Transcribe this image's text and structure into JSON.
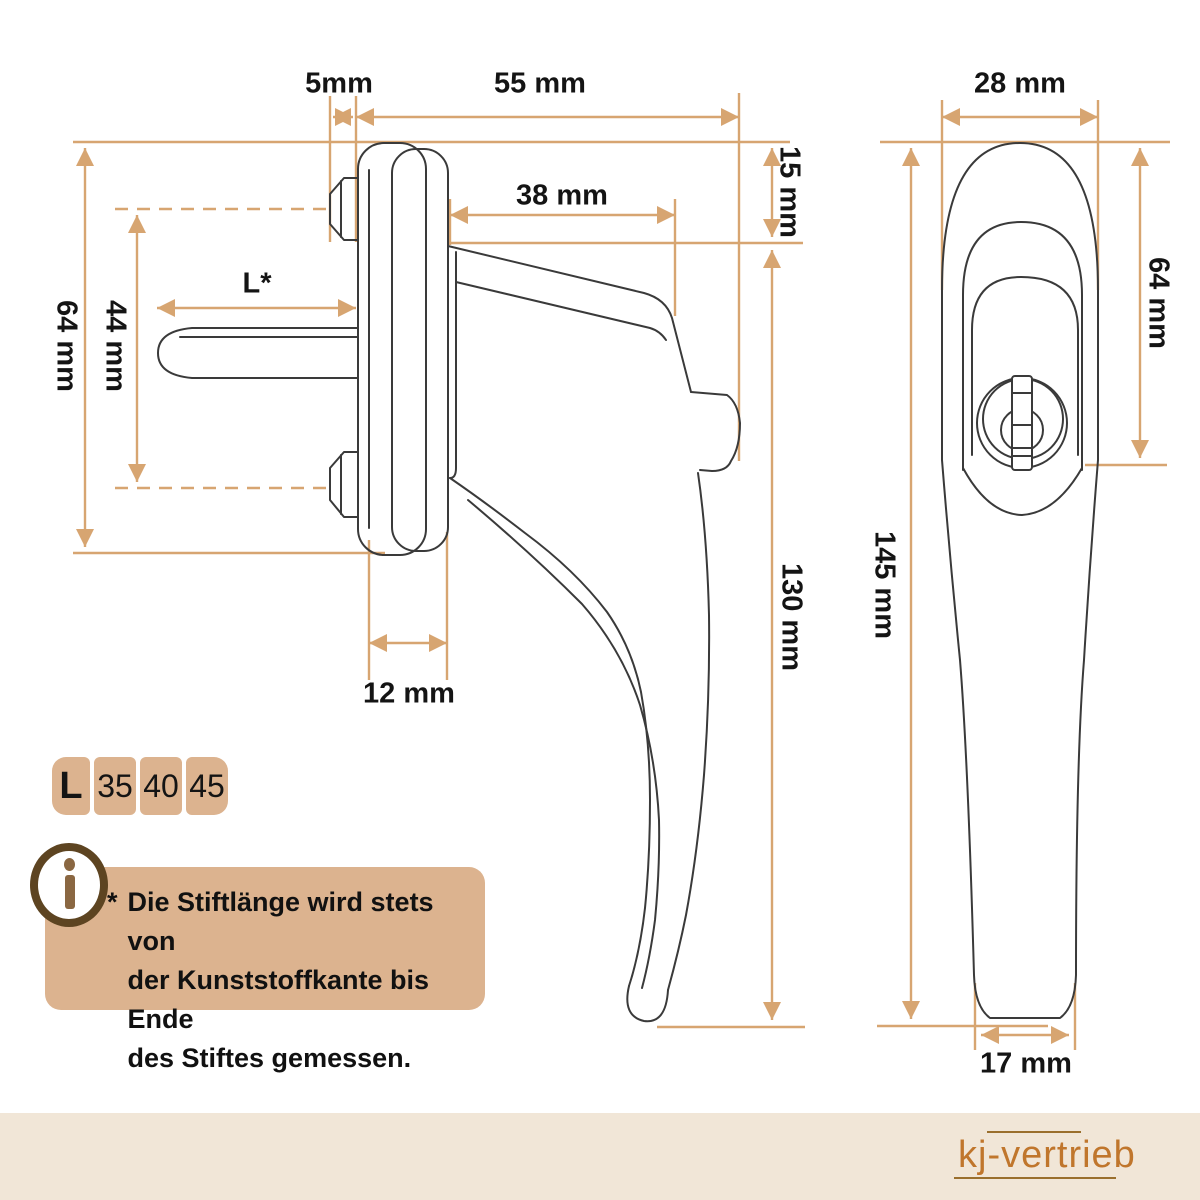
{
  "title": "Fenstergriff Masszeichnung",
  "colors": {
    "dimension_accent": "#d7a571",
    "drawing_line": "#3a3a3a",
    "panel_tan": "#dcb38f",
    "footer_beige": "#f1e6d7",
    "brand_orange": "#c0762c",
    "icon_ring_brown": "#5d4421",
    "icon_glyph_brown": "#8a6742"
  },
  "side_view": {
    "pin_offset": "5mm",
    "handle_depth": "55 mm",
    "neck_length": "38 mm",
    "cover_height": "15 mm",
    "handle_height": "130 mm",
    "rosette_height": "64 mm",
    "screw_spacing": "44 mm",
    "spindle_length": "L*",
    "rosette_depth": "12 mm"
  },
  "front_view": {
    "handle_width": "28 mm",
    "upper_height": "64 mm",
    "total_height": "145 mm",
    "grip_width": "17 mm"
  },
  "length_table": {
    "header": "L",
    "options": [
      "35",
      "40",
      "45"
    ]
  },
  "info": {
    "icon": "info-icon",
    "marker": "*",
    "lines": [
      "Die Stiftlänge wird stets von",
      "der Kunststoffkante bis Ende",
      "des Stiftes gemessen."
    ]
  },
  "footer": {
    "brand": "kj-vertrieb"
  }
}
